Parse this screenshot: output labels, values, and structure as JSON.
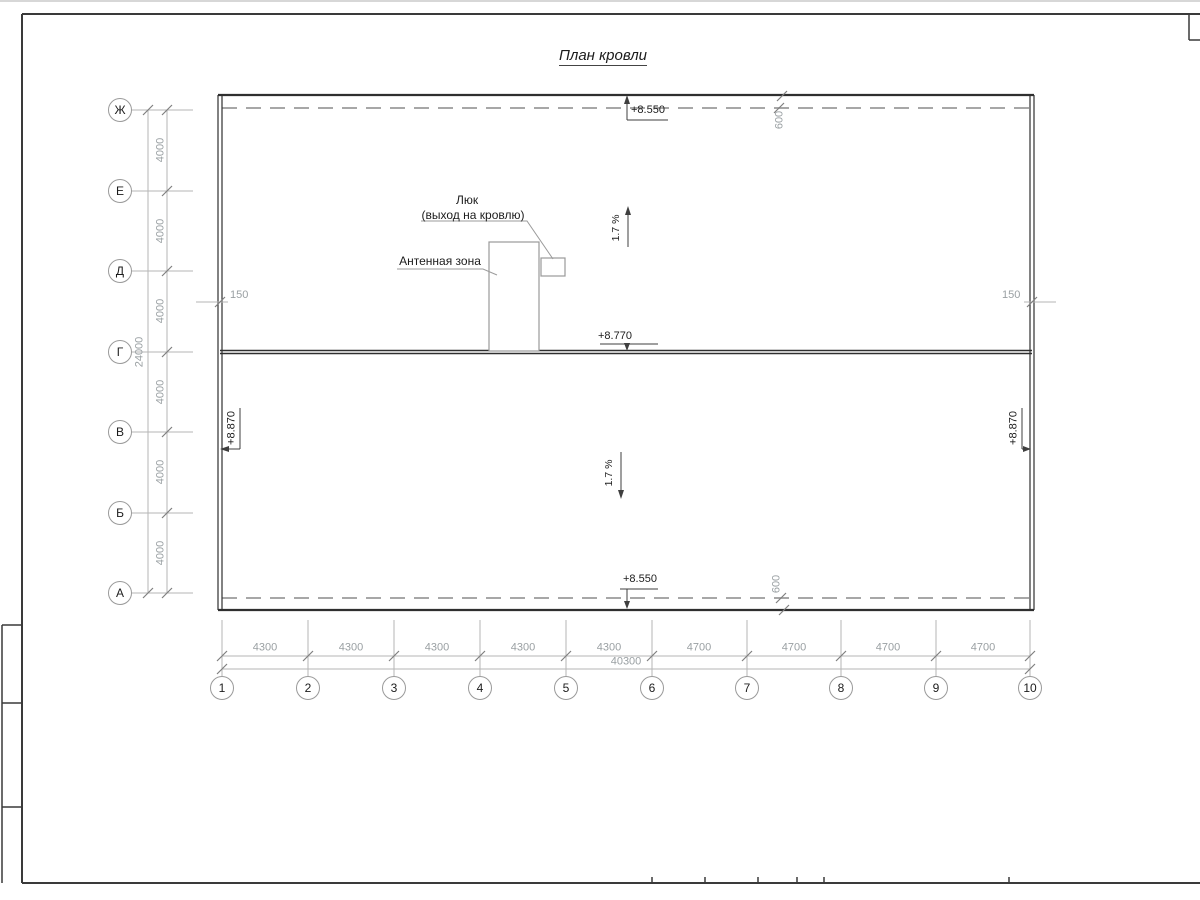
{
  "title": "План кровли",
  "row_axes": [
    "Ж",
    "Е",
    "Д",
    "Г",
    "В",
    "Б",
    "А"
  ],
  "col_axes": [
    "1",
    "2",
    "3",
    "4",
    "5",
    "6",
    "7",
    "8",
    "9",
    "10"
  ],
  "row_spacings": [
    "4000",
    "4000",
    "4000",
    "4000",
    "4000",
    "4000"
  ],
  "row_total": "24000",
  "col_spacings": [
    "4300",
    "4300",
    "4300",
    "4300",
    "4300",
    "4700",
    "4700",
    "4700",
    "4700"
  ],
  "col_total": "40300",
  "elevations": {
    "eave_top": "+8.550",
    "ridge": "+8.770",
    "eave_bottom": "+8.550",
    "parapet_left": "+8.870",
    "parapet_right": "+8.870"
  },
  "offsets": {
    "left": "150",
    "right": "150",
    "overhang_top": "600",
    "overhang_bottom": "600"
  },
  "slopes": {
    "upper": "1.7 %",
    "lower": "1.7 %"
  },
  "annotations": {
    "hatch_title": "Люк",
    "hatch_subtitle": "(выход на кровлю)",
    "antenna": "Антенная зона"
  },
  "colors": {
    "wall_line": "#2f2f2f",
    "dim_line": "#b5b5b5",
    "dim_text": "#9aa0a3",
    "dark_text": "#1c1c1c"
  }
}
